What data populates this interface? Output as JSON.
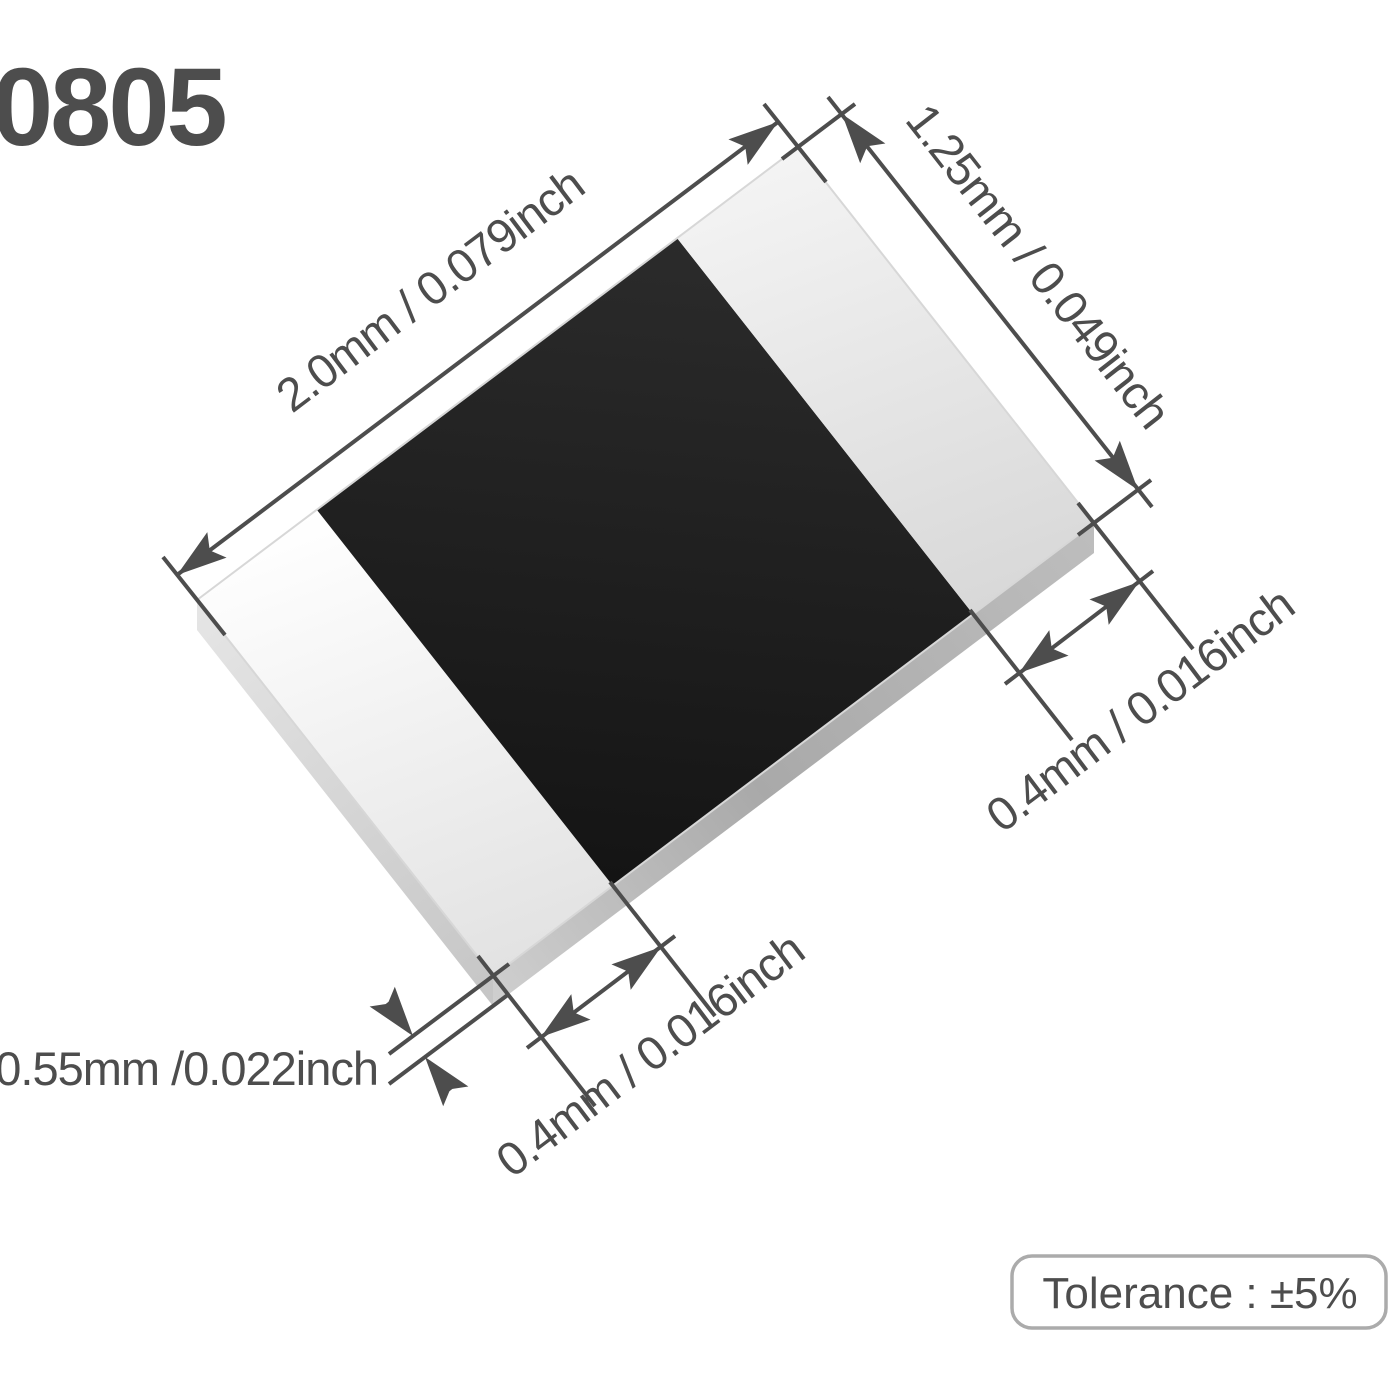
{
  "figure": {
    "part_label": "0805",
    "dim_length": "2.0mm / 0.079inch",
    "dim_width": "1.25mm / 0.049inch",
    "dim_cap_right": "0.4mm / 0.016inch",
    "dim_cap_bottom": "0.4mm / 0.016inch",
    "dim_thickness": "0.55mm /0.022inch",
    "tolerance_label": "Tolerance : ±5%"
  },
  "colors": {
    "ink": "#4d4d4d",
    "body_black": "#1d1d1d",
    "terminal_silver": "#ececec",
    "side_gray": "#b0b0b0",
    "box_border": "#ababab",
    "background": "#ffffff"
  }
}
